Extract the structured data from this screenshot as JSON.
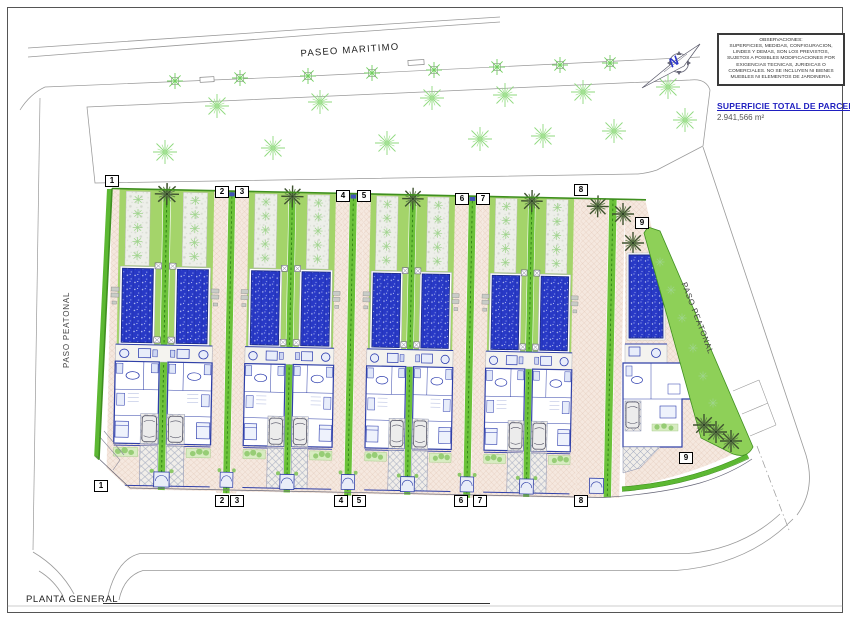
{
  "drawing": {
    "streets": {
      "paseo_maritimo": "PASEO MARITIMO",
      "paso_peatonal_left": "PASO PEATONAL",
      "paso_peatonal_right": "PASO PEATONAL"
    },
    "caption": "PLANTA GENERAL",
    "north_letter": "N",
    "notes": {
      "lines": [
        "OBSERVACIONES:",
        "SUPERFICIES, MEDIDAS, CONFIGURACION,",
        "LINDES Y DEMAS, SON LOS PREVISTOS,",
        "SUJETOS A POSIBLES MODIFICACIONES POR",
        "EXIGENCIAS TECNICAS, JURIDICAS O",
        "COMERCIALES. NO SE INCLUYEN NI BIENES",
        "MUEBLES NI ELEMENTOS DE JARDINERIA."
      ]
    },
    "area": {
      "label": "SUPERFICIE TOTAL DE PARCELA",
      "value": "2.941,566 m²"
    },
    "plots": {
      "top": [
        "1",
        "2",
        "3",
        "4",
        "5",
        "6",
        "7",
        "8"
      ],
      "bottom": [
        "1",
        "2",
        "3",
        "4",
        "5",
        "6",
        "7",
        "8"
      ],
      "corner_top": "9",
      "corner_bottom": "9"
    },
    "colors": {
      "lawn": "#a4d46a",
      "hedge_green": "#6cc23a",
      "pool_blue": "#2839c6",
      "wall_blue": "#3040a8",
      "paving_pink": "#f5e8df",
      "heading_blue": "#1f1fc0",
      "tree_green": "#8fd97e"
    }
  }
}
